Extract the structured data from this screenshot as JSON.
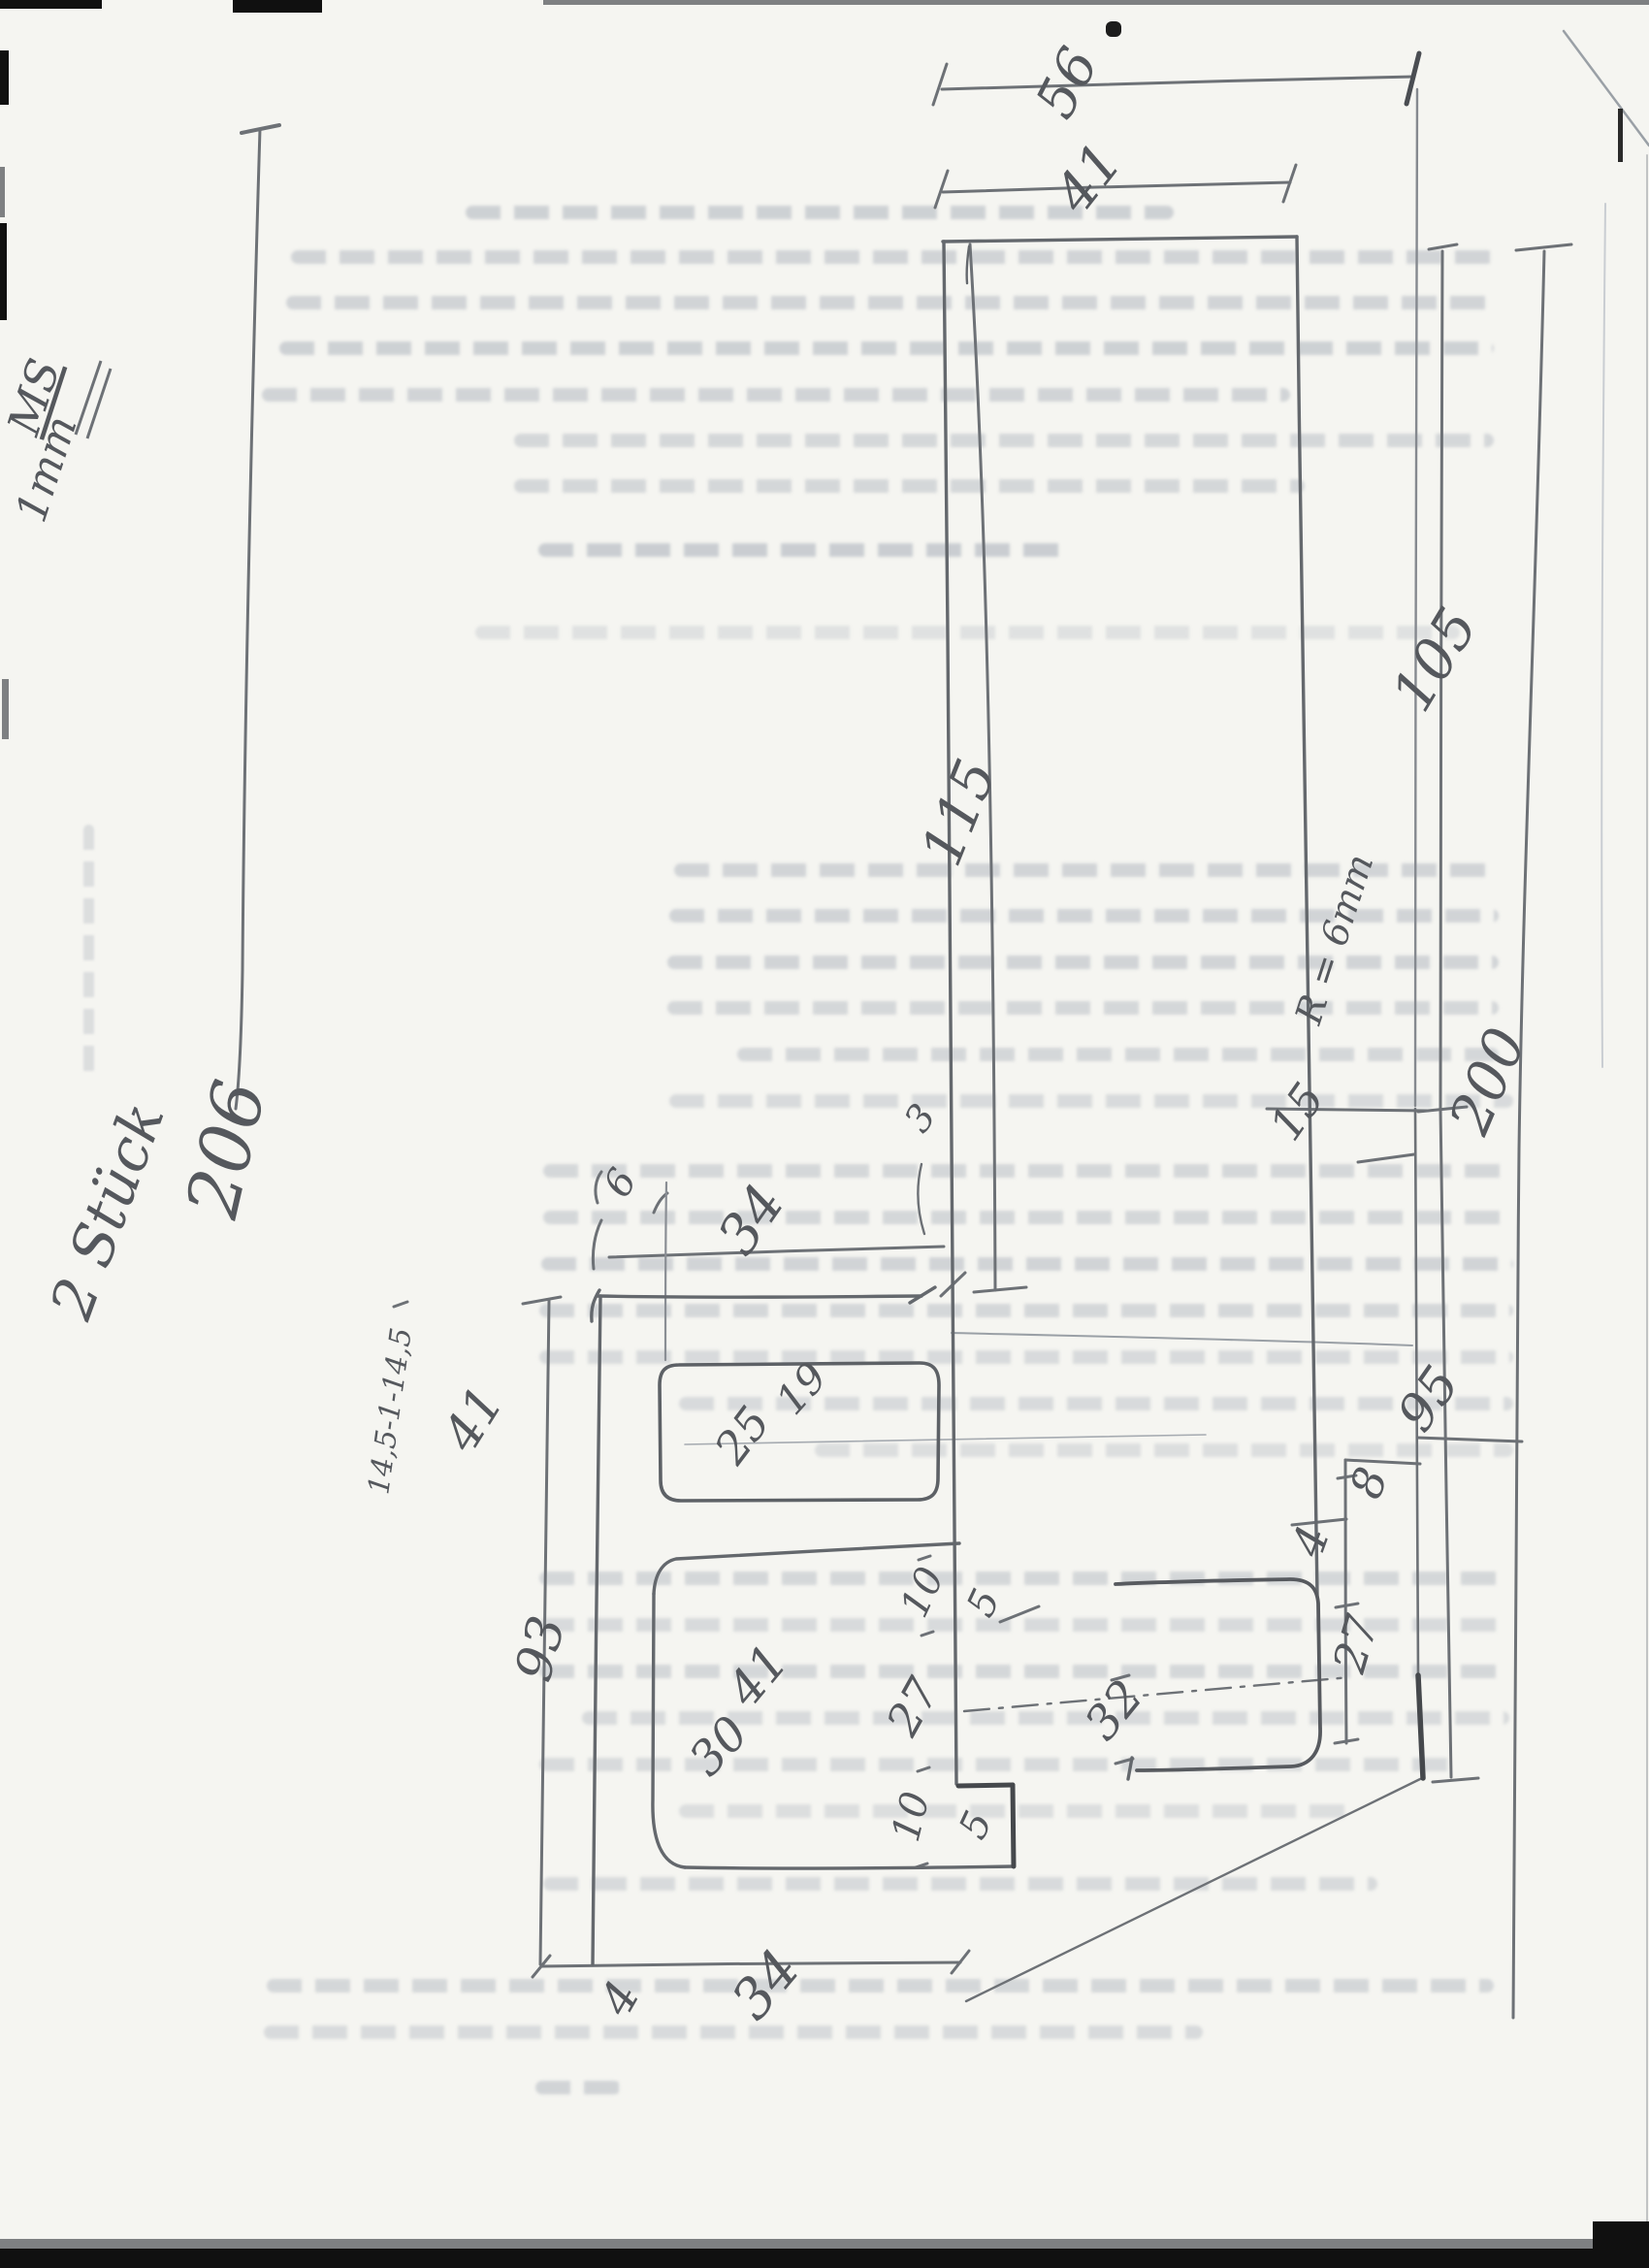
{
  "sketch": {
    "quantity_note": "2 Stück",
    "material_note": {
      "thickness": "1mm",
      "material": "MS"
    },
    "annotations": {
      "corner_radius": "R = 6mm"
    },
    "dimensions": {
      "length_left_overall": "206",
      "top_outer_width": "56",
      "top_inner_width": "41",
      "bar_length": "115",
      "right_upper_length": "105",
      "right_lower_length": "95",
      "right_total_length": "200",
      "step_width": "15",
      "tab_offset": "8",
      "tab_gap": "4",
      "tab_depth_right": "27",
      "tab_height": "32",
      "edge_offset": "6",
      "mid_width_top": "34",
      "edge_gap": "3",
      "width_chain": "14,5-1-14,5",
      "mid_length": "41",
      "left_lower_length": "93",
      "slot_length": "25",
      "slot_width": "19",
      "notch_width_upper": "10",
      "notch_depth_upper": "5",
      "lower_length": "41",
      "lower_width": "30",
      "lower_right_depth": "27",
      "lower_notch": "10",
      "lower_step": "5",
      "bottom_width": "34",
      "bottom_flange": "4"
    }
  }
}
